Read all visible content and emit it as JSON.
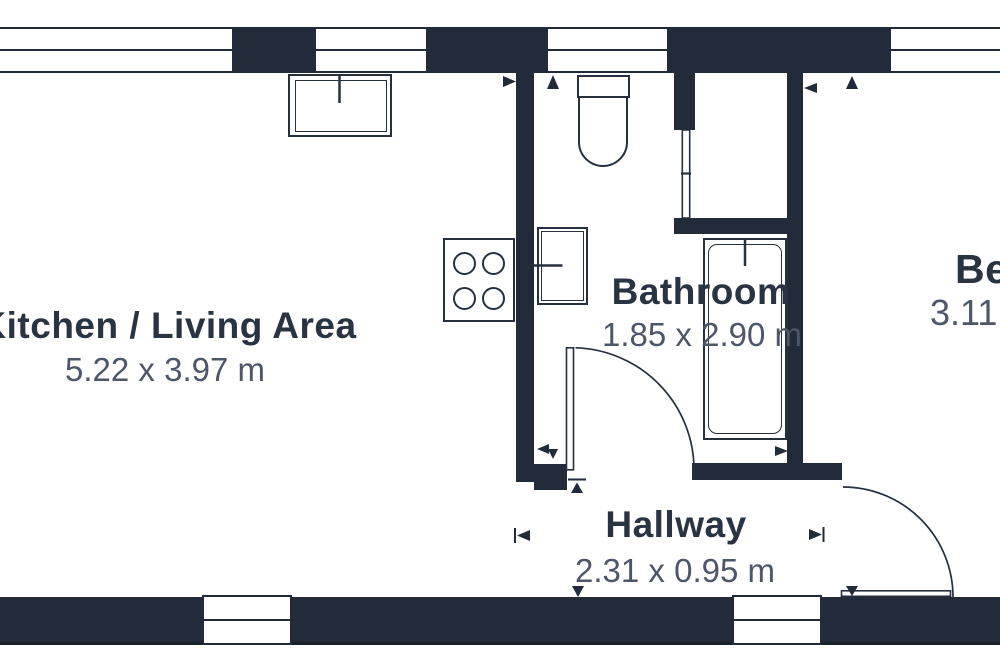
{
  "floorplan": {
    "background_color": "#ffffff",
    "wall_color": "#212b39",
    "line_color": "#27303e",
    "label_color": "#293342",
    "dimension_color": "#4e5669",
    "rooms": {
      "kitchen": {
        "label": "Kitchen / Living Area",
        "dimensions": "5.22 x 3.97 m"
      },
      "bathroom": {
        "label": "Bathroom",
        "dimensions": "1.85 x 2.90 m"
      },
      "hallway": {
        "label": "Hallway",
        "dimensions": "2.31 x 0.95 m"
      },
      "bedroom": {
        "label": "Bedroom",
        "dimensions": "3.11"
      }
    },
    "fixtures": [
      "kitchen-sink",
      "stove",
      "toilet",
      "bathroom-sink",
      "bathtub",
      "shower-door",
      "windows",
      "doors"
    ]
  }
}
